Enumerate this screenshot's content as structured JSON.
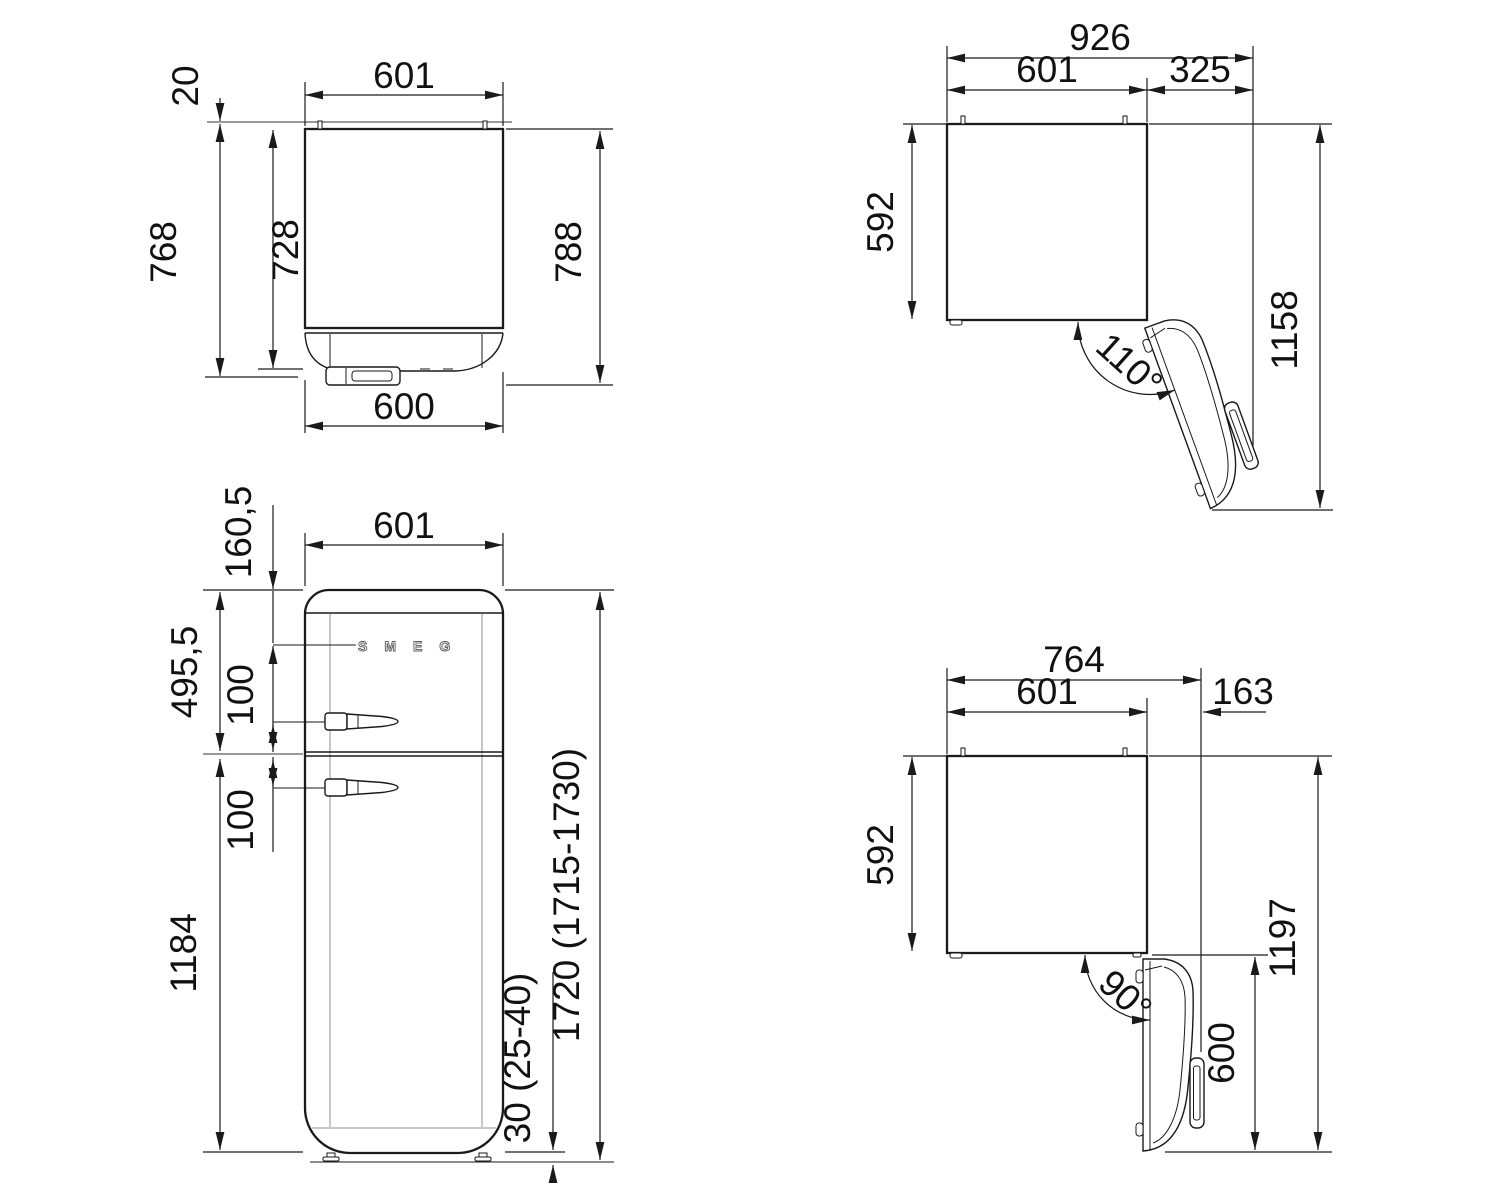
{
  "page": {
    "background": "#ffffff",
    "line_color": "#1a1a1a",
    "guide_color": "#9a9a9a",
    "description": "Refrigerator installation dimension drawing, four views"
  },
  "views": {
    "plan_closed": {
      "dims": {
        "width_top": "601",
        "wall_clearance": "20",
        "depth_total": "768",
        "depth_body": "728",
        "depth_overall": "788",
        "width_bottom": "600"
      }
    },
    "plan_open_110": {
      "dims": {
        "width_total": "926",
        "width_body": "601",
        "door_protrusion": "325",
        "depth_body": "592",
        "depth_total": "1158",
        "door_angle": "110°"
      }
    },
    "front": {
      "logo": "SMEG",
      "dims": {
        "width": "601",
        "logo_offset": "160,5",
        "top_section": "495,5",
        "handle_upper": "100",
        "handle_lower": "100",
        "bottom_section": "1184",
        "total_height": "1720 (1715-1730)",
        "feet_height": "30 (25-40)"
      }
    },
    "plan_open_90": {
      "dims": {
        "width_total": "764",
        "width_body": "601",
        "door_protrusion": "163",
        "depth_body": "592",
        "depth_total": "1197",
        "door_side": "600",
        "door_angle": "90°"
      }
    }
  }
}
